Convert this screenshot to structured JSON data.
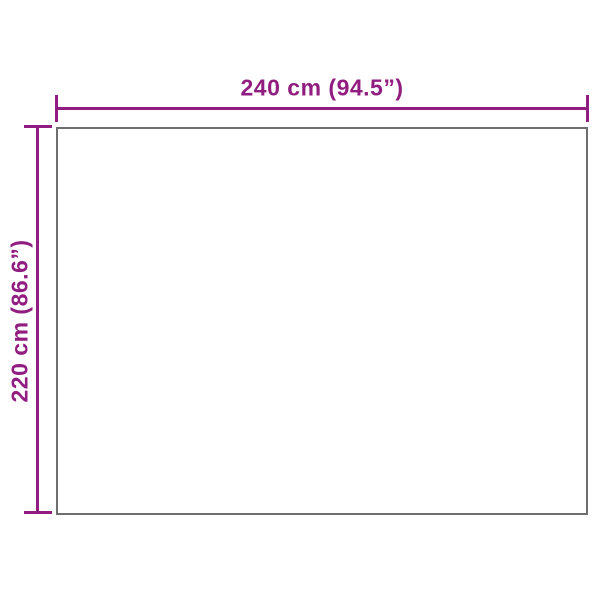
{
  "diagram": {
    "type": "product-dimension-diagram",
    "background_color": "#ffffff",
    "accent_color": "#911d80",
    "outline_color": "#6e6e6e",
    "width_label": "240 cm (94.5”)",
    "height_label": "220 cm (86.6”)",
    "width_value_cm": 240,
    "width_value_in": 94.5,
    "height_value_cm": 220,
    "height_value_in": 86.6
  }
}
